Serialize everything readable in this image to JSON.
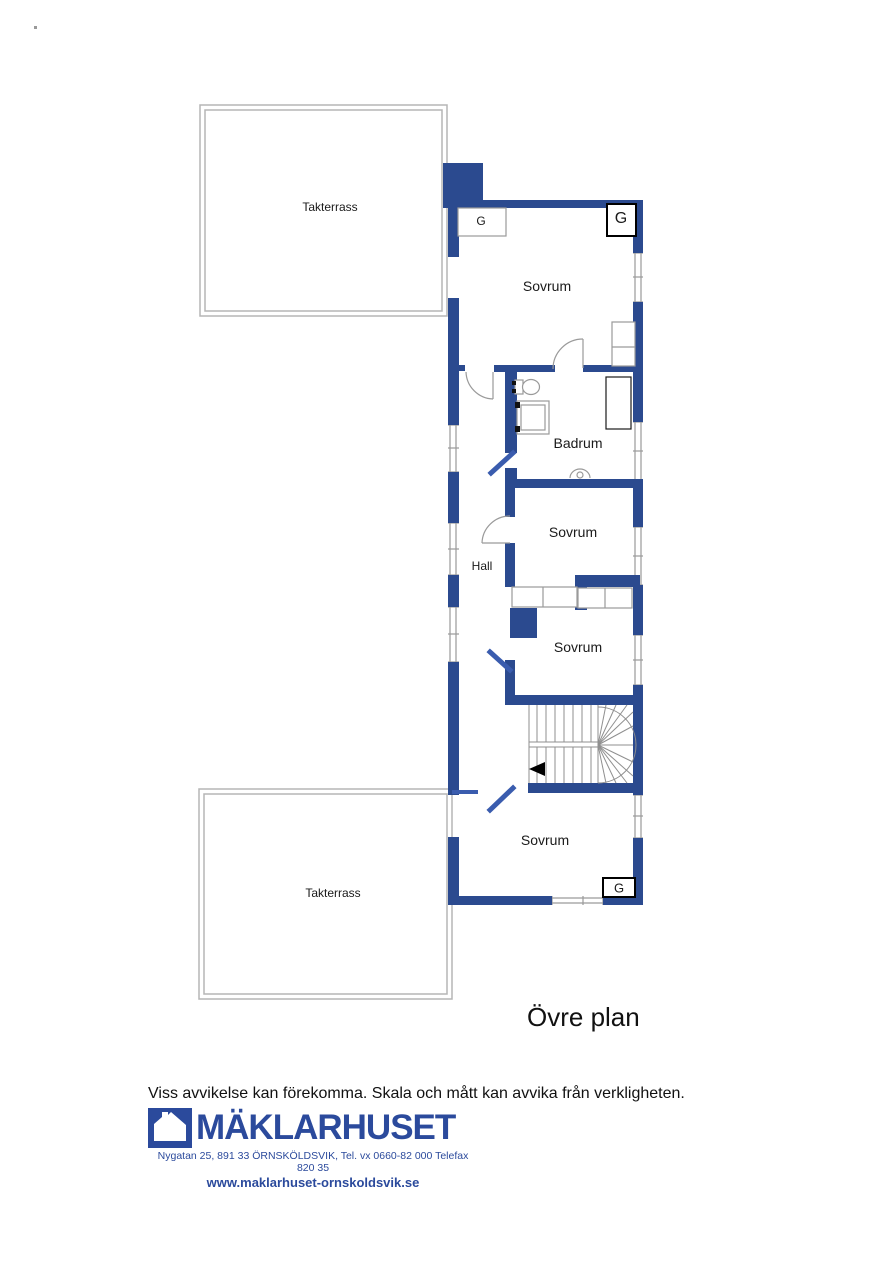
{
  "plan": {
    "title": "Övre plan",
    "rooms": {
      "terrace_top": "Takterrass",
      "terrace_bottom": "Takterrass",
      "sovrum_top": "Sovrum",
      "badrum": "Badrum",
      "hall": "Hall",
      "sovrum_mid": "Sovrum",
      "sovrum_third": "Sovrum",
      "sovrum_bottom": "Sovrum"
    },
    "closet_label": "G",
    "icons": {
      "stairs_direction": "left-arrow"
    }
  },
  "footer": {
    "disclaimer": "Viss avvikelse kan förekomma. Skala och mått kan avvika från verkligheten.",
    "brand": "MÄKLARHUSET",
    "address": "Nygatan 25, 891 33 ÖRNSKÖLDSVIK, Tel. vx 0660-82 000 Telefax 820 35",
    "website": "www.maklarhuset-ornskoldsvik.se"
  },
  "colors": {
    "wall_blue": "#2b4a8f",
    "door_blue": "#3a5cae",
    "brand_blue": "#2b4a9c",
    "terrace_border_gray": "#b5b5b5",
    "fixture_gray": "#9a9a9a"
  }
}
